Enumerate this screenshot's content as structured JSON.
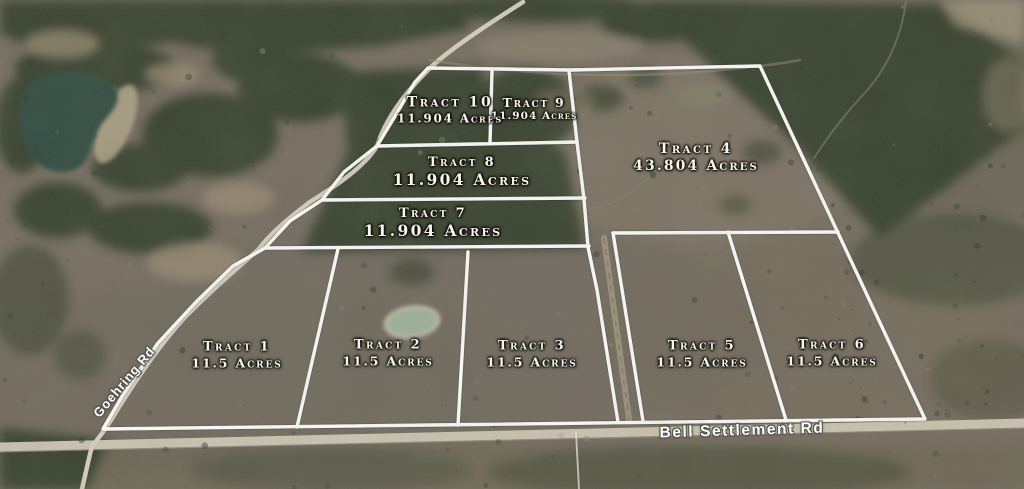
{
  "tracts": [
    {
      "id": "tract-1",
      "name": "Tract 1",
      "acres": "11.5 Acres"
    },
    {
      "id": "tract-2",
      "name": "Tract 2",
      "acres": "11.5 Acres"
    },
    {
      "id": "tract-3",
      "name": "Tract 3",
      "acres": "11.5 Acres"
    },
    {
      "id": "tract-4",
      "name": "Tract 4",
      "acres": "43.804 Acres"
    },
    {
      "id": "tract-5",
      "name": "Tract 5",
      "acres": "11.5 Acres"
    },
    {
      "id": "tract-6",
      "name": "Tract 6",
      "acres": "11.5 Acres"
    },
    {
      "id": "tract-7",
      "name": "Tract 7",
      "acres": "11.904 Acres"
    },
    {
      "id": "tract-8",
      "name": "Tract 8",
      "acres": "11.904 Acres"
    },
    {
      "id": "tract-9",
      "name": "Tract 9",
      "acres": "11.904 Acres"
    },
    {
      "id": "tract-10",
      "name": "Tract 10",
      "acres": "11.904 Acres"
    }
  ],
  "roads": [
    {
      "name": "Goehring Rd"
    },
    {
      "name": "Bell Settlement Rd"
    }
  ],
  "colors": {
    "boundary_line": "#ffffff",
    "tract_label_text": "#faf6ec",
    "road_label_text": "#ffffff",
    "road_surface": "#cdc5b3",
    "field": "#756c60",
    "forest": "#333e2c",
    "lake_water": "#2e4a40",
    "pond_water": "#9fb29e"
  }
}
